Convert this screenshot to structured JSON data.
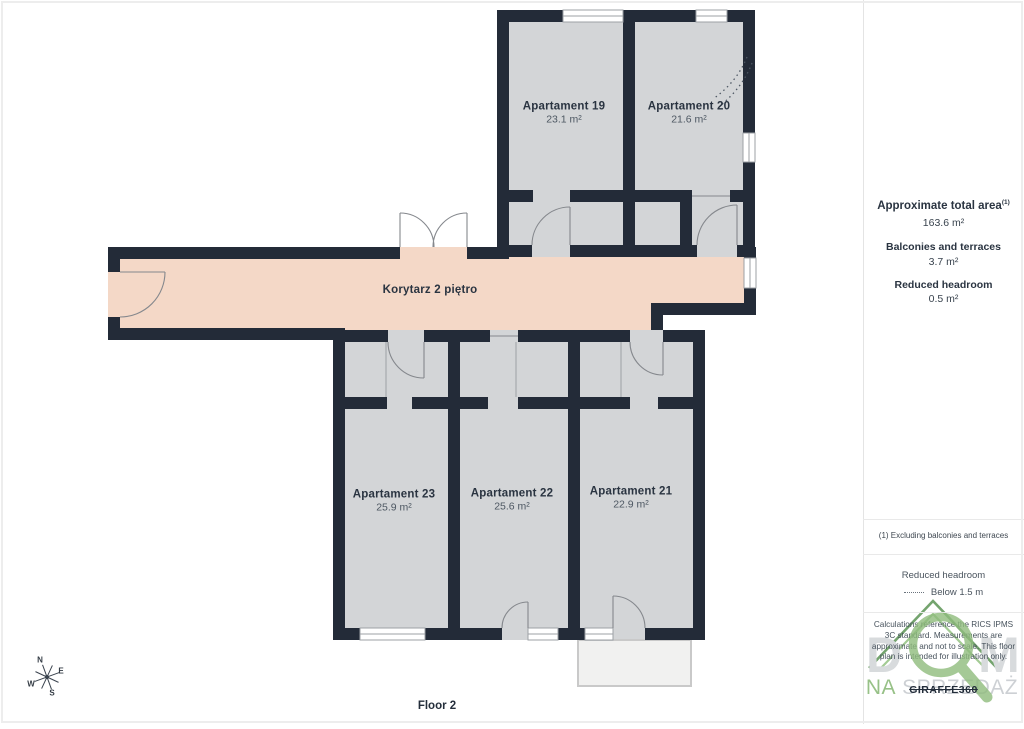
{
  "floor_label": "Floor 2",
  "compass": {
    "north": "N",
    "east": "E",
    "south": "S",
    "west": "W"
  },
  "rooms": [
    {
      "name": "Apartament 19",
      "area": "23.1 m²"
    },
    {
      "name": "Apartament 20",
      "area": "21.6 m²"
    },
    {
      "name": "Korytarz 2 piętro",
      "area": ""
    },
    {
      "name": "Apartament 23",
      "area": "25.9 m²"
    },
    {
      "name": "Apartament 22",
      "area": "25.6 m²"
    },
    {
      "name": "Apartament 21",
      "area": "22.9 m²"
    }
  ],
  "sidebar": {
    "total_area_label": "Approximate total area",
    "total_area_footnote_marker": "(1)",
    "total_area_value": "163.6 m²",
    "balconies_label": "Balconies and terraces",
    "balconies_value": "3.7 m²",
    "reduced_headroom_label": "Reduced headroom",
    "reduced_headroom_value": "0.5 m²",
    "footnote": "(1) Excluding balconies and terraces",
    "legend_title": "Reduced headroom",
    "legend_value": "Below 1.5 m",
    "disclaimer": "Calculations reference the RICS IPMS 3C standard. Measurements are approximate and not to scale. This floor plan is intended for illustration only.",
    "logo_text": "GIRAFFE360"
  },
  "watermark": {
    "letter_left": "D",
    "letter_right": "M",
    "subtitle_left": "NA",
    "subtitle_right": "SPRZEDAŻ"
  },
  "colors": {
    "wall": "#232B38",
    "room_fill": "#D3D5D7",
    "corridor_fill": "#F4D8C7",
    "balcony_fill": "#F1F1F0",
    "watermark_green": "#8FBC7D",
    "text_dark": "#2A3441"
  }
}
